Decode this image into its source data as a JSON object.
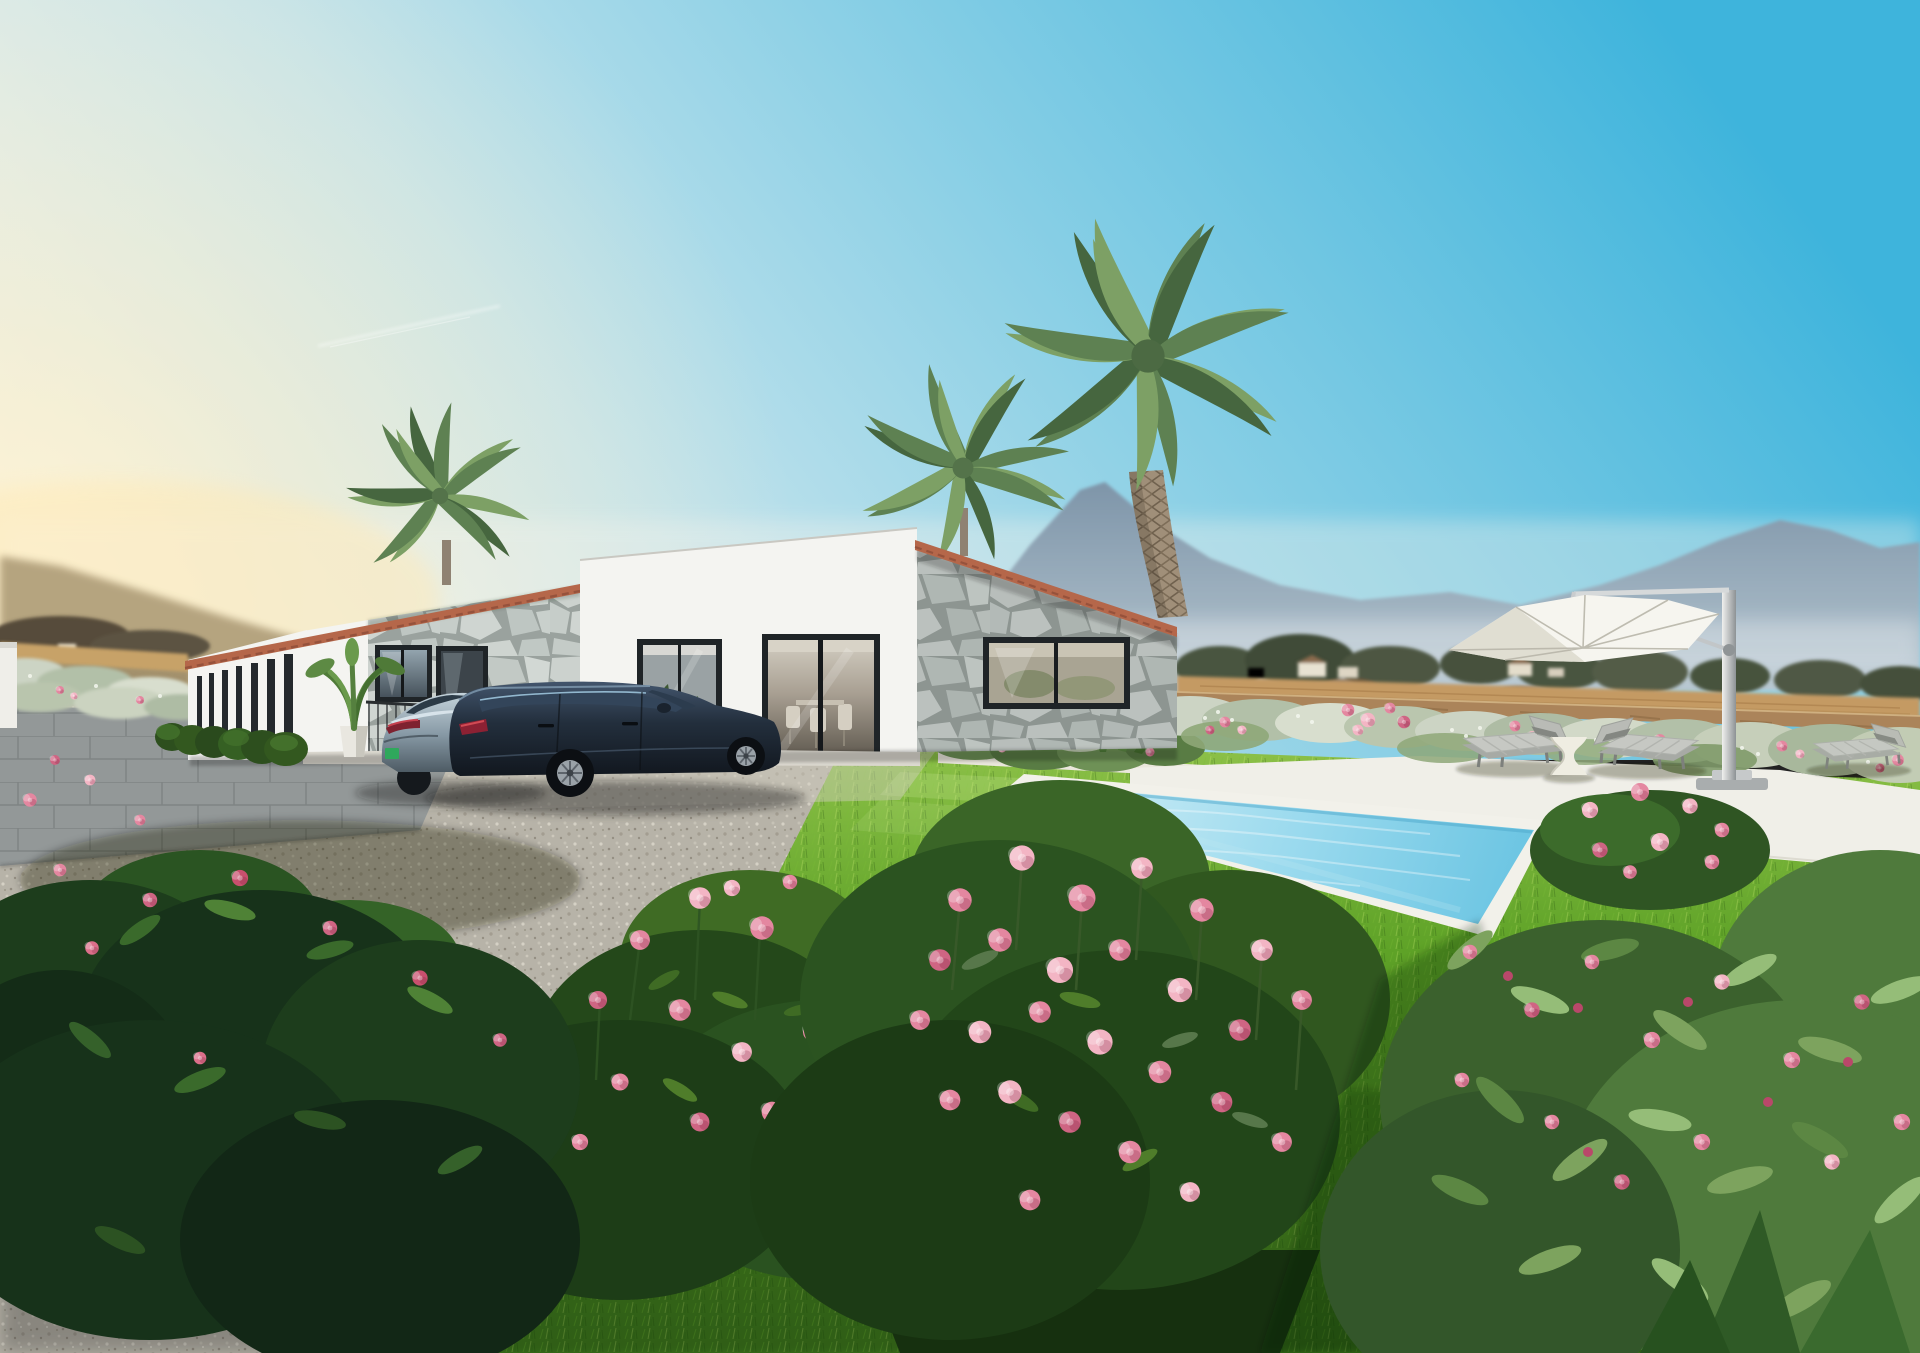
{
  "scene": {
    "title": "Modern stone villa render with pool and rose garden",
    "description": "Photorealistic exterior rendering of a single-storey modern villa with natural stone cladding and terracotta roof edges, three palm trees, a gravel and paver driveway with a grey sedan and a dark estate car, a turquoise lap pool with white coping, two grey sun loungers with a white side table and a white cantilever parasol, bright lawn, silvery flowering border against a dry field and hazy blue mountains, and pink rose and oleander bushes in the foreground under a clear cyan sky with a low sun at the left.",
    "time_of_day": "late afternoon sunshine from the left",
    "objects": [
      "villa with stone cladding",
      "left wing with slit windows",
      "glass sliding doors",
      "picture window",
      "palm trees",
      "potted plant",
      "boxwood hedge",
      "grey sedan",
      "dark estate car",
      "gravel courtyard",
      "paver parking",
      "lap pool",
      "pool steps",
      "white pool deck",
      "walkway",
      "sun loungers",
      "drum side table",
      "cantilever parasol",
      "rose bushes",
      "oleander bushes",
      "flower border",
      "dry field wall",
      "mountain range",
      "contrail"
    ]
  },
  "palette": {
    "sky_top": "#3eb4dc",
    "sky_horizon": "#eef2ef",
    "sun_glow": "#fff4d4",
    "mountain": "#7e95a9",
    "field": "#c49a63",
    "wall_stone": "#ab845a",
    "wall_white": "#f4f4f1",
    "wall_shade": "#e3e2dd",
    "terracotta": "#b5674a",
    "frame": "#1f2427",
    "stone_grout": "#9aa29e",
    "lawn_far": "#8fc24a",
    "lawn_near": "#3c6d1c",
    "gravel": "#b7b3a8",
    "paver": "#a4a9aa",
    "walkway": "#eae7dc",
    "deck": "#f0efe8",
    "coping": "#f2f1ea",
    "pool_far": "#d7f0f6",
    "pool_near": "#6ec6e3",
    "umbrella": "#f6f5ef",
    "lounger": "#c6c8c3",
    "car_wagon": "#232f3d",
    "car_sedan": "#8fa3b0",
    "rose_light": "#f3b5c4",
    "rose_mid": "#e487a0",
    "rose_deep": "#cf6583",
    "leaf_dark": "#24481a",
    "leaf_mid": "#3f6b24",
    "oleander_1": "#7da35e",
    "oleander_2": "#95bd78",
    "oleander_3": "#5c8743",
    "frond_a": "#5e8152",
    "frond_b": "#7da065",
    "frond_c": "#46663f"
  }
}
